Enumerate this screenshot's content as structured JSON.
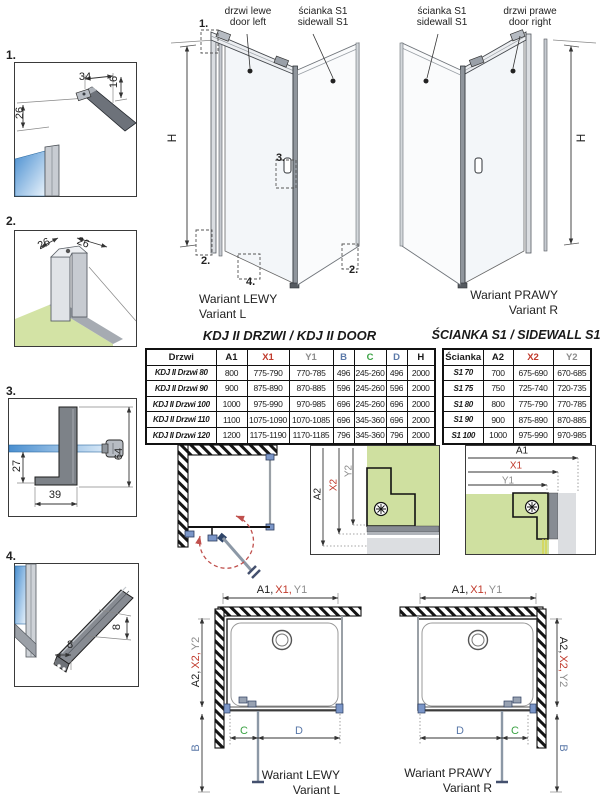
{
  "colors": {
    "red": "#c0392b",
    "blue": "#5a78a8",
    "green": "#3aa243",
    "gray": "#8c8c8c",
    "glass_blue": "#4a8fd0",
    "wall_green": "#cfe0a0",
    "floor_green": "#d3e3a5",
    "hinge_navy": "#2e4468",
    "bracket_blue": "#7b96c8"
  },
  "labels": {
    "h": "H"
  },
  "details": {
    "d1": {
      "label": "1.",
      "dim_top": "34",
      "dim_right": "16",
      "dim_left": "26"
    },
    "d2": {
      "label": "2.",
      "dim_left": "26",
      "dim_right": "26"
    },
    "d3": {
      "label": "3.",
      "dim_left": "27",
      "dim_bottom": "39",
      "dim_right": "64"
    },
    "d4": {
      "label": "4.",
      "dim_right": "8",
      "dim_bottom": "8"
    }
  },
  "perspective": {
    "left": {
      "door_label": "drzwi lewe\ndoor left",
      "sidewall_label": "ścianka S1\nsidewall S1",
      "callout_top": "1.",
      "callout_handle": "3.",
      "callout_bottom_left": "2.",
      "callout_bottom_center": "4.",
      "callout_bottom_right": "2.",
      "caption": "Wariant LEWY\nVariant L"
    },
    "right": {
      "sidewall_label": "ścianka S1\nsidewall S1",
      "door_label": "drzwi prawe\ndoor right",
      "caption": "Wariant PRAWY\nVariant R"
    }
  },
  "door_table": {
    "title": "KDJ II DRZWI / KDJ II DOOR",
    "headers": [
      {
        "label": "Drzwi",
        "color": "#1a1a1a"
      },
      {
        "label": "A1",
        "color": "#1a1a1a"
      },
      {
        "label": "X1",
        "color": "#c0392b"
      },
      {
        "label": "Y1",
        "color": "#8c8c8c"
      },
      {
        "label": "B",
        "color": "#5a78a8"
      },
      {
        "label": "C",
        "color": "#3aa243"
      },
      {
        "label": "D",
        "color": "#5a78a8"
      },
      {
        "label": "H",
        "color": "#1a1a1a"
      }
    ],
    "rows": [
      {
        "name": "KDJ II Drzwi 80",
        "values": [
          "800",
          "775-790",
          "770-785",
          "496",
          "245-260",
          "496",
          "2000"
        ]
      },
      {
        "name": "KDJ II Drzwi 90",
        "values": [
          "900",
          "875-890",
          "870-885",
          "596",
          "245-260",
          "596",
          "2000"
        ]
      },
      {
        "name": "KDJ II Drzwi 100",
        "values": [
          "1000",
          "975-990",
          "970-985",
          "696",
          "245-260",
          "696",
          "2000"
        ]
      },
      {
        "name": "KDJ II Drzwi 110",
        "values": [
          "1100",
          "1075-1090",
          "1070-1085",
          "696",
          "345-360",
          "696",
          "2000"
        ]
      },
      {
        "name": "KDJ II Drzwi 120",
        "values": [
          "1200",
          "1175-1190",
          "1170-1185",
          "796",
          "345-360",
          "796",
          "2000"
        ]
      }
    ]
  },
  "sidewall_table": {
    "title": "ŚCIANKA S1 / SIDEWALL S1",
    "headers": [
      {
        "label": "Ścianka",
        "color": "#1a1a1a"
      },
      {
        "label": "A2",
        "color": "#1a1a1a"
      },
      {
        "label": "X2",
        "color": "#c0392b"
      },
      {
        "label": "Y2",
        "color": "#8c8c8c"
      }
    ],
    "rows": [
      {
        "name": "S1 70",
        "values": [
          "700",
          "675-690",
          "670-685"
        ]
      },
      {
        "name": "S1 75",
        "values": [
          "750",
          "725-740",
          "720-735"
        ]
      },
      {
        "name": "S1 80",
        "values": [
          "800",
          "775-790",
          "770-785"
        ]
      },
      {
        "name": "S1 90",
        "values": [
          "900",
          "875-890",
          "870-885"
        ]
      },
      {
        "name": "S1 100",
        "values": [
          "1000",
          "975-990",
          "970-985"
        ]
      }
    ]
  },
  "sections": {
    "sidewall": {
      "a2": "A2",
      "x2": "X2",
      "y2": "Y2"
    },
    "door": {
      "a1": "A1",
      "x1": "X1",
      "y1": "Y1"
    }
  },
  "plans": {
    "left": {
      "dim_top": {
        "a1": "A1,",
        "x1": "X1,",
        "y1": "Y1"
      },
      "dim_side": {
        "a2": "A2,",
        "x2": "X2,",
        "y2": "Y2"
      },
      "dim_b": "B",
      "dim_c": "C",
      "dim_d": "D",
      "caption": "Wariant LEWY\nVariant L"
    },
    "right": {
      "dim_top": {
        "a1": "A1,",
        "x1": "X1,",
        "y1": "Y1"
      },
      "dim_side": {
        "a2": "A2,",
        "x2": "X2,",
        "y2": "Y2"
      },
      "dim_b": "B",
      "dim_c": "C",
      "dim_d": "D",
      "caption": "Wariant PRAWY\nVariant R"
    }
  }
}
